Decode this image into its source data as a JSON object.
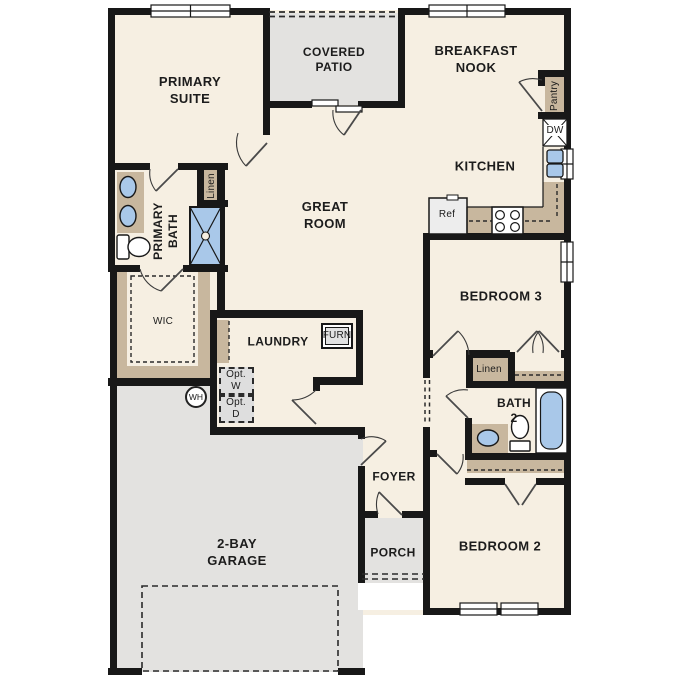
{
  "labels": {
    "primary_suite": "PRIMARY\nSUITE",
    "covered_patio": "COVERED\nPATIO",
    "breakfast_nook": "BREAKFAST\nNOOK",
    "kitchen": "KITCHEN",
    "great_room": "GREAT\nROOM",
    "primary_bath": "PRIMARY\nBATH",
    "linen_primary": "Linen",
    "wic": "WIC",
    "laundry": "LAUNDRY",
    "furnace": "FURN",
    "opt_washer": "Opt.\nW",
    "opt_dryer": "Opt.\nD",
    "water_heater": "WH",
    "pantry": "Pantry",
    "dishwasher": "DW",
    "refrigerator": "Ref",
    "bedroom_3": "BEDROOM 3",
    "linen_hall": "Linen",
    "bath_2": "BATH\n2",
    "bedroom_2": "BEDROOM 2",
    "foyer": "FOYER",
    "porch": "PORCH",
    "garage": "2-BAY\nGARAGE"
  },
  "colors": {
    "wall": "#181818",
    "floor": "#f6efe2",
    "outdoor": "#e3e2e0",
    "cabinet": "#c8b79e",
    "fixture_blue": "#a9c8e9",
    "option_box": "#dedede"
  }
}
